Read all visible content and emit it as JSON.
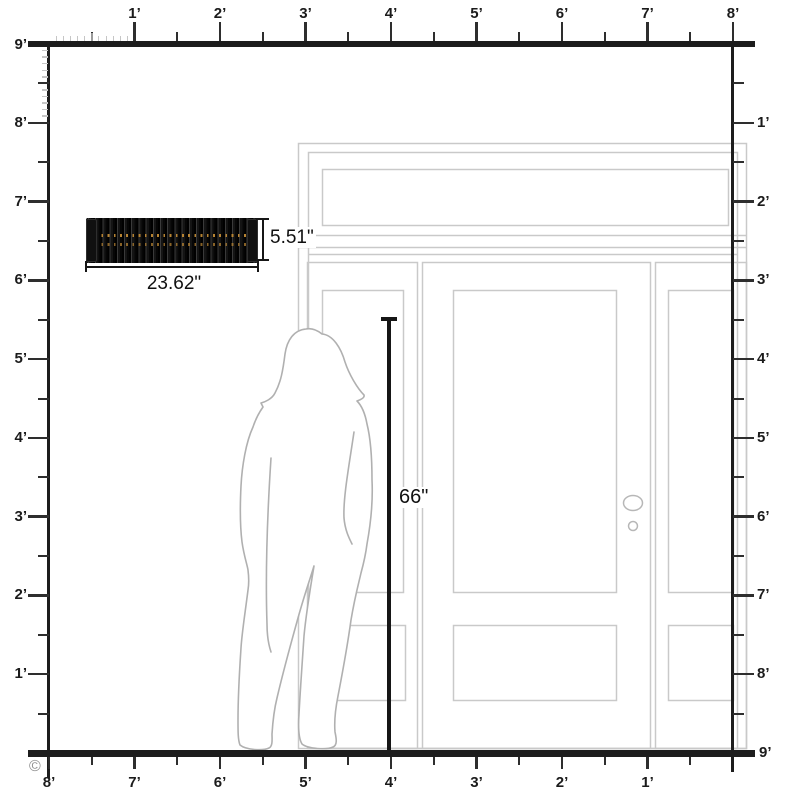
{
  "title": "Size comparison diagram",
  "rulers": {
    "unit_suffix": "’",
    "top": {
      "labels": [
        "1’",
        "2’",
        "3’",
        "4’",
        "5’",
        "6’",
        "7’",
        "8’"
      ]
    },
    "left": {
      "top_label": "9’",
      "labels": [
        "8’",
        "7’",
        "6’",
        "5’",
        "4’",
        "3’",
        "2’",
        "1’"
      ]
    },
    "right": {
      "labels": [
        "1’",
        "2’",
        "3’",
        "4’",
        "5’",
        "6’",
        "7’",
        "8’"
      ],
      "bottom_label": "9’"
    },
    "bottom": {
      "labels": [
        "8’",
        "7’",
        "6’",
        "5’",
        "4’",
        "3’",
        "2’",
        "1’"
      ]
    }
  },
  "product": {
    "width_label": "23.62\"",
    "height_label": "5.51\""
  },
  "person": {
    "height_label": "66\""
  },
  "copyright_symbol": "©",
  "colors": {
    "ruler": "#1d1d1d",
    "minor_tick": "#c6c6c6",
    "door_outline": "#c9c9c9",
    "person_outline": "#b0b0b0",
    "dimension": "#161616",
    "product_body": "#0d0d0d",
    "product_dots": "#c08a35",
    "copyright": "#8f8f8f"
  }
}
